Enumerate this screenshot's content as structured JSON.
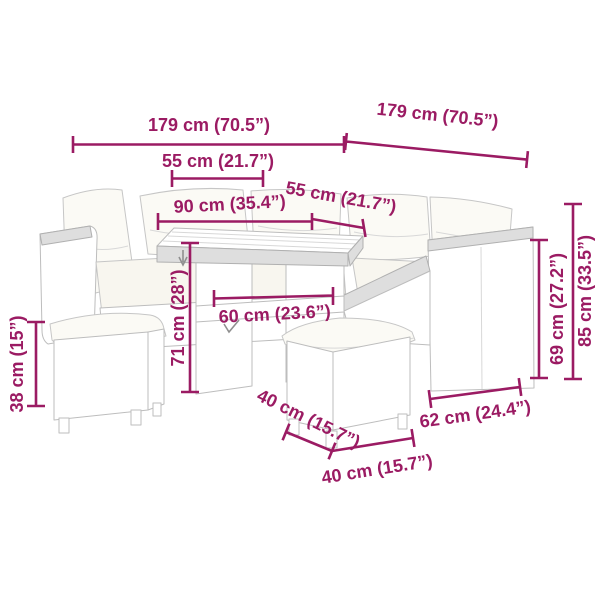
{
  "meta": {
    "accent_color": "#9B1B63",
    "background_color": "#ffffff",
    "illustration": "poly-rattan garden lounge set: corner sofa with cushions, table, two stools, annotated with dimensions"
  },
  "dimensions": {
    "front_width": "179 cm (70.5”)",
    "side_width": "179 cm (70.5”)",
    "seat_width": "55 cm (21.7”)",
    "table_length": "90 cm (35.4”)",
    "seat_depth": "55 cm (21.7”)",
    "table_height": "71 cm (28”)",
    "table_depth": "60 cm (23.6”)",
    "stool_height": "38 cm (15”)",
    "stool_depth": "40 cm (15.7”)",
    "stool_width": "40 cm (15.7”)",
    "sofa_depth": "62 cm (24.4”)",
    "backrest_height": "69 cm (27.2”)",
    "overall_height": "85 cm (33.5”)"
  }
}
